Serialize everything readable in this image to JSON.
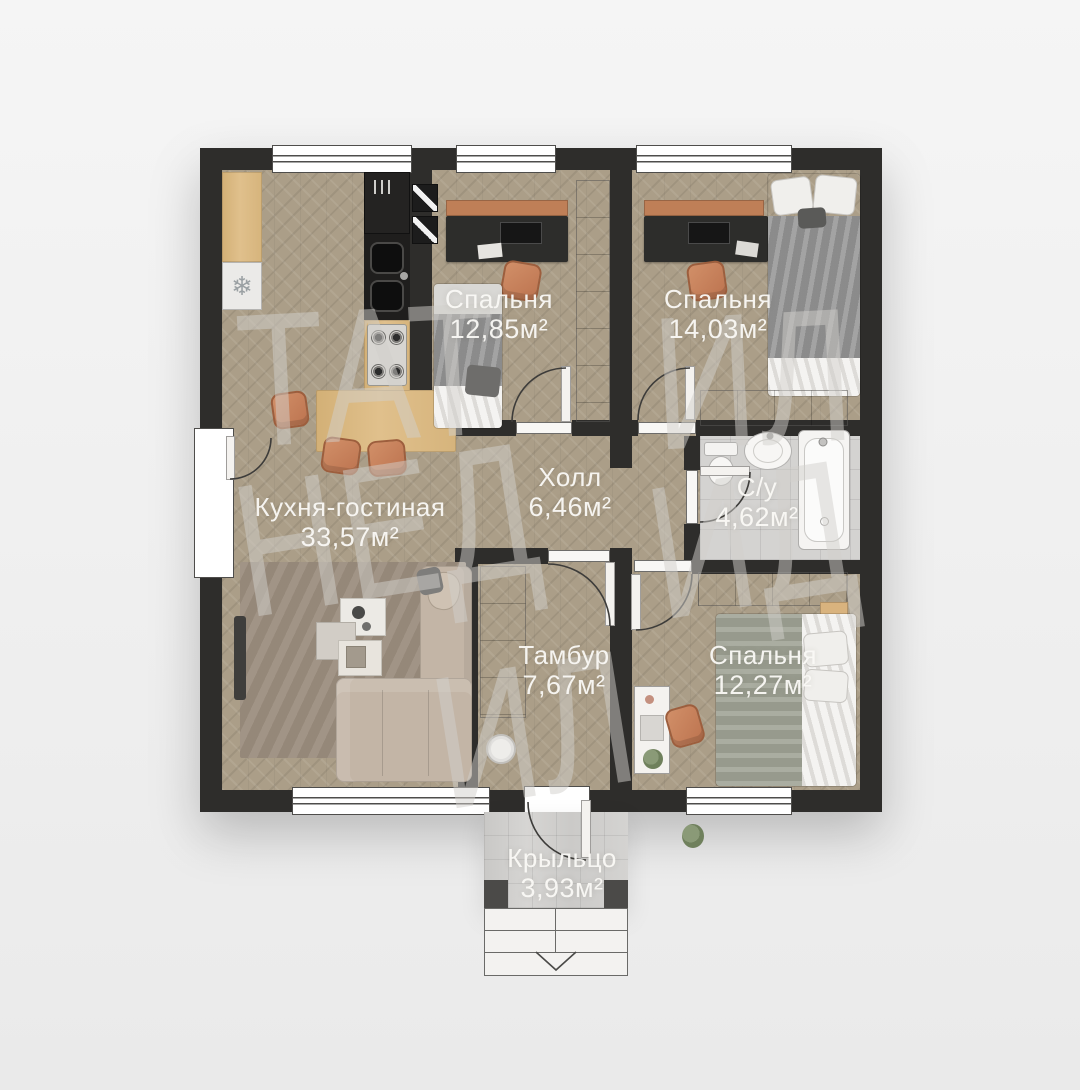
{
  "plan": {
    "rooms": [
      {
        "id": "bedroom-1",
        "name": "Спальня",
        "area": "12,85м²"
      },
      {
        "id": "bedroom-2",
        "name": "Спальня",
        "area": "14,03м²"
      },
      {
        "id": "kitchen-living",
        "name": "Кухня-гостиная",
        "area": "33,57м²"
      },
      {
        "id": "hall",
        "name": "Холл",
        "area": "6,46м²"
      },
      {
        "id": "bathroom",
        "name": "С/у",
        "area": "4,62м²"
      },
      {
        "id": "vestibule",
        "name": "Тамбур",
        "area": "7,67м²"
      },
      {
        "id": "bedroom-3",
        "name": "Спальня",
        "area": "12,27м²"
      },
      {
        "id": "porch",
        "name": "Крыльцо",
        "area": "3,93м²"
      }
    ],
    "watermark": {
      "pieces": [
        "ТАТ",
        "ИЛ",
        "НЕД",
        "ИД",
        "ИЛ"
      ]
    },
    "icons": {
      "snowflake": "❄"
    },
    "colors": {
      "wall": "#2e2d2b",
      "parquet": "#ab9e88",
      "tile": "#d4d3d1",
      "wood": "#dcbd8a",
      "copper": "#c8815c",
      "furniture_white": "#f4f2ef"
    }
  }
}
